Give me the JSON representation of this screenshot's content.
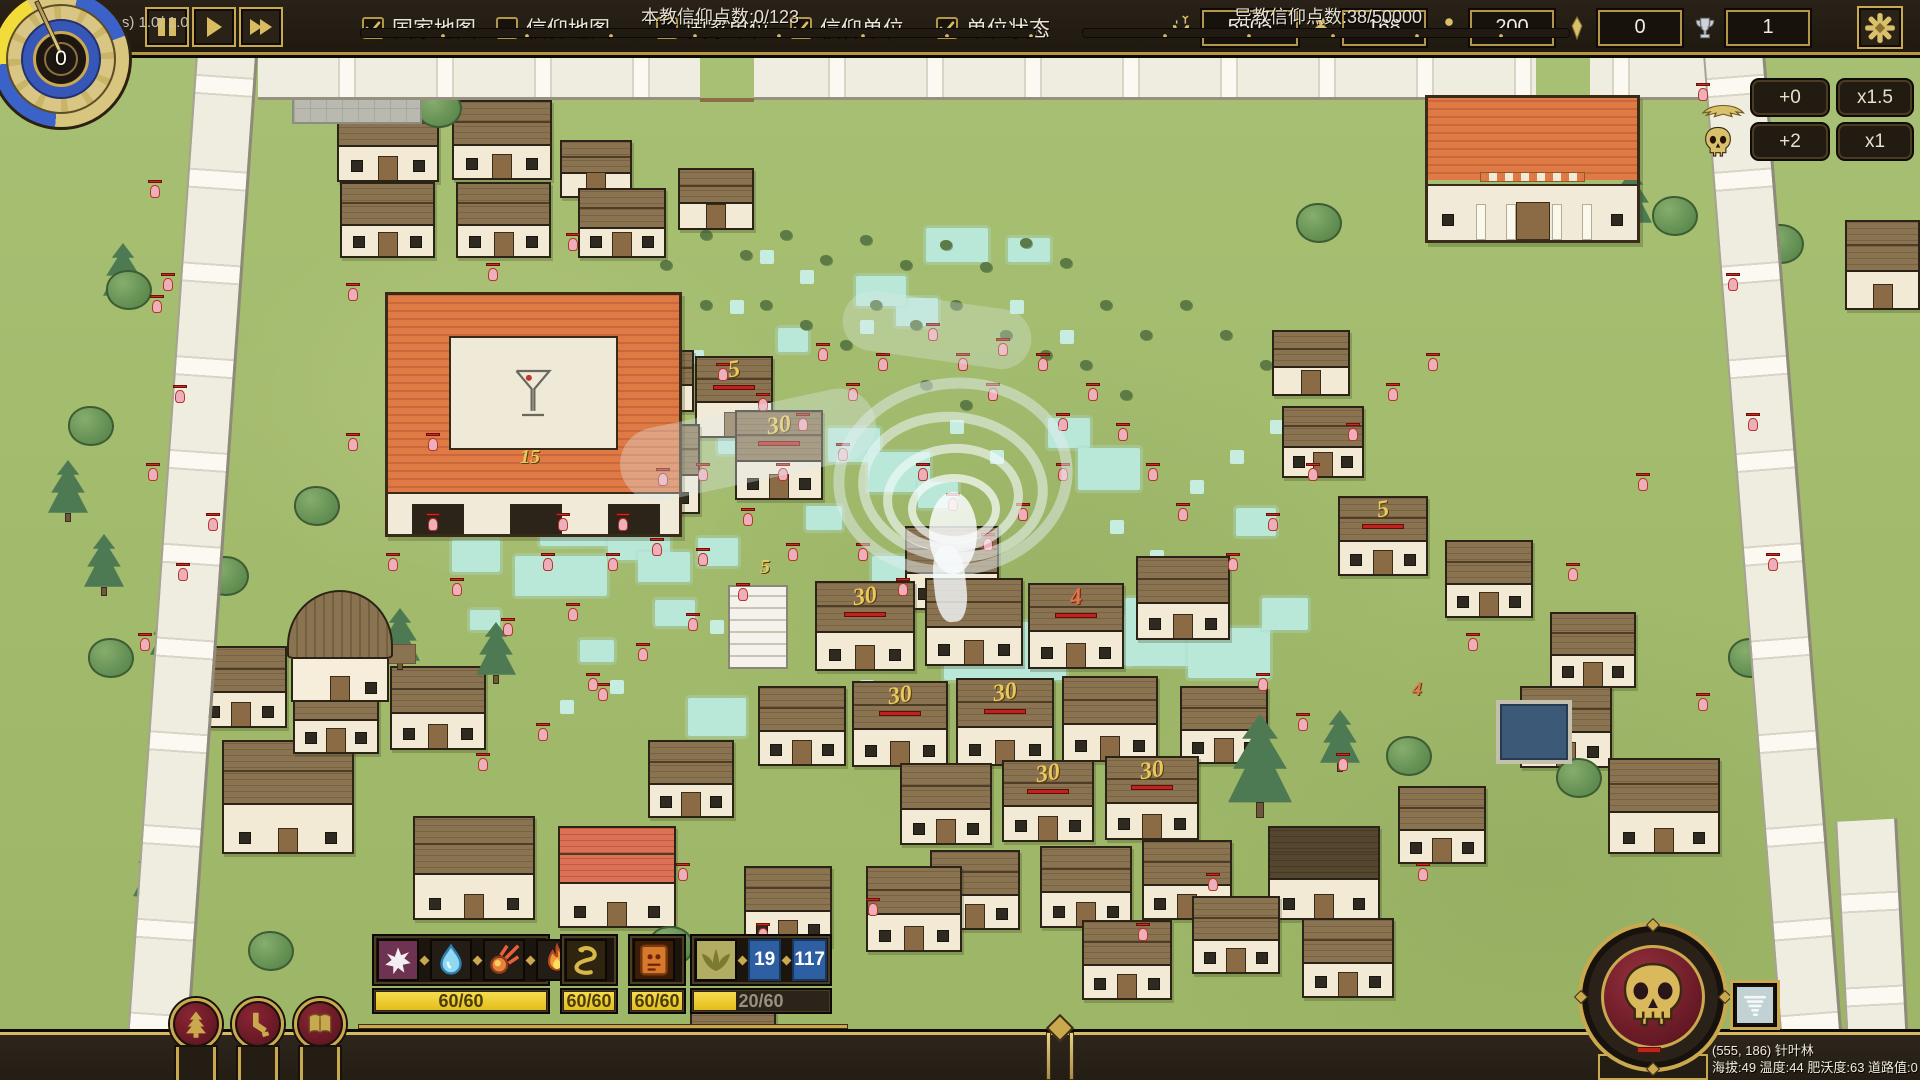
{
  "top_bar": {
    "playback": [
      {
        "name": "pause-button",
        "icon": "pause"
      },
      {
        "name": "play-button",
        "icon": "play"
      },
      {
        "name": "fast-forward-button",
        "icon": "ff"
      }
    ],
    "toggles": [
      {
        "name": "country-map",
        "label": "国家地图",
        "checked": true,
        "gap": 20
      },
      {
        "name": "faith-map",
        "label": "信仰地图",
        "checked": false,
        "gap": 46
      },
      {
        "name": "country-units",
        "label": "国家单位",
        "checked": false,
        "gap": 20
      },
      {
        "name": "faith-units",
        "label": "信仰单位",
        "checked": true,
        "gap": 32
      },
      {
        "name": "unit-status",
        "label": "单位状态",
        "checked": true,
        "gap": 0
      }
    ],
    "resources": [
      {
        "icon": "deer-icon",
        "value": "5505",
        "wide": true
      },
      {
        "icon": "rabbit-icon",
        "value": "168",
        "wide": false
      },
      {
        "icon": "person-icon",
        "value": "200",
        "wide": false
      },
      {
        "icon": "gem-icon",
        "value": "0",
        "wide": false
      },
      {
        "icon": "trophy-icon",
        "value": "1",
        "wide": false
      }
    ]
  },
  "clock": {
    "value": "0"
  },
  "modifier_panel": {
    "rows": [
      {
        "icon": "winged-idol-icon",
        "add": "+0",
        "mult": "x1.5"
      },
      {
        "icon": "skull-small-icon",
        "add": "+2",
        "mult": "x1"
      }
    ]
  },
  "abilities": {
    "groups": [
      {
        "x": 372,
        "w": 178,
        "icons": [
          "splat-icon",
          "waterdrop-icon",
          "meteor-icon",
          "flame-icon"
        ],
        "cooldown": "60/60",
        "fill": 100
      },
      {
        "x": 560,
        "w": 58,
        "icons": [
          "snake-icon"
        ],
        "cooldown": "60/60",
        "fill": 100
      },
      {
        "x": 628,
        "w": 58,
        "icons": [
          "tablet-icon"
        ],
        "cooldown": "60/60",
        "fill": 100
      },
      {
        "x": 690,
        "w": 142,
        "icons": [
          "wings-icon"
        ],
        "counters": [
          "19",
          "117"
        ],
        "cooldown": "20/60",
        "fill": 33
      }
    ]
  },
  "medallions": [
    {
      "name": "nature-medallion",
      "icon": "tree-icon"
    },
    {
      "name": "beast-medallion",
      "icon": "paw-icon"
    },
    {
      "name": "lore-medallion",
      "icon": "book-icon"
    }
  ],
  "faith": {
    "own": "本教信仰点数:0/123",
    "enemy": "异教信仰点数:38/50000"
  },
  "perf": "16.7 ms (60 fps) 1.0/ 1.0",
  "tile_info": {
    "line1": "(555, 186) 针叶林",
    "line2": "海拔:49 温度:44 肥沃度:63 道路值:0"
  },
  "map": {
    "houses": [
      [
        337,
        100,
        102,
        82,
        "b"
      ],
      [
        452,
        100,
        100,
        80,
        "b"
      ],
      [
        340,
        182,
        95,
        76,
        "b"
      ],
      [
        456,
        182,
        95,
        76,
        "b"
      ],
      [
        560,
        140,
        72,
        58,
        "b"
      ],
      [
        578,
        188,
        88,
        70,
        "b"
      ],
      [
        678,
        168,
        76,
        62,
        "b"
      ],
      [
        622,
        350,
        72,
        62,
        "b"
      ],
      [
        695,
        356,
        78,
        82,
        "b",
        "5",
        "g"
      ],
      [
        618,
        424,
        82,
        90,
        "b"
      ],
      [
        735,
        410,
        88,
        90,
        "b",
        "30",
        "g"
      ],
      [
        905,
        526,
        94,
        84,
        "b"
      ],
      [
        1136,
        556,
        94,
        84,
        "b"
      ],
      [
        815,
        581,
        100,
        90,
        "b",
        "30",
        "g"
      ],
      [
        925,
        578,
        98,
        88,
        "b"
      ],
      [
        1028,
        583,
        96,
        86,
        "b",
        "4",
        "o"
      ],
      [
        758,
        686,
        88,
        80,
        "b"
      ],
      [
        852,
        681,
        96,
        86,
        "b",
        "30",
        "g"
      ],
      [
        956,
        678,
        98,
        88,
        "b",
        "30",
        "g"
      ],
      [
        1062,
        676,
        96,
        86,
        "b"
      ],
      [
        1180,
        686,
        88,
        78,
        "b"
      ],
      [
        900,
        763,
        92,
        82,
        "b"
      ],
      [
        1002,
        760,
        92,
        82,
        "b",
        "30",
        "g"
      ],
      [
        1105,
        756,
        94,
        84,
        "b",
        "30",
        "g"
      ],
      [
        930,
        850,
        90,
        80,
        "b"
      ],
      [
        1040,
        846,
        92,
        82,
        "b"
      ],
      [
        1142,
        840,
        90,
        80,
        "b"
      ],
      [
        1282,
        406,
        82,
        72,
        "b"
      ],
      [
        1272,
        330,
        78,
        66,
        "b"
      ],
      [
        1338,
        496,
        90,
        80,
        "b",
        "5",
        "g"
      ],
      [
        1445,
        540,
        88,
        78,
        "b"
      ],
      [
        1550,
        612,
        86,
        76,
        "b"
      ],
      [
        1520,
        686,
        92,
        82,
        "b"
      ],
      [
        1608,
        758,
        112,
        96,
        "b"
      ],
      [
        195,
        646,
        92,
        82,
        "b"
      ],
      [
        222,
        740,
        132,
        114,
        "b"
      ],
      [
        390,
        666,
        96,
        84,
        "b"
      ],
      [
        293,
        676,
        86,
        78,
        "b"
      ],
      [
        413,
        816,
        122,
        104,
        "b"
      ],
      [
        558,
        826,
        118,
        102,
        "r"
      ],
      [
        648,
        740,
        86,
        78,
        "b"
      ],
      [
        866,
        866,
        96,
        86,
        "b"
      ],
      [
        744,
        866,
        88,
        80,
        "b"
      ],
      [
        1268,
        826,
        112,
        94,
        "d"
      ],
      [
        1398,
        786,
        88,
        78,
        "b"
      ],
      [
        1845,
        220,
        75,
        90,
        "b"
      ],
      [
        1082,
        920,
        90,
        80,
        "b"
      ],
      [
        1192,
        896,
        88,
        78,
        "b"
      ],
      [
        1302,
        918,
        92,
        80,
        "b"
      ],
      [
        690,
        993,
        86,
        72,
        "b"
      ]
    ],
    "trees": [
      [
        48,
        460,
        "p"
      ],
      [
        84,
        534,
        "p"
      ],
      [
        150,
        602,
        "p"
      ],
      [
        380,
        608,
        "p"
      ],
      [
        476,
        622,
        "p"
      ],
      [
        598,
        442,
        "p"
      ],
      [
        103,
        243,
        "p"
      ],
      [
        1320,
        710,
        "p"
      ],
      [
        1612,
        170,
        "p"
      ],
      [
        1742,
        194,
        "p"
      ],
      [
        133,
        808,
        "P"
      ],
      [
        1228,
        714,
        "P"
      ],
      [
        106,
        270,
        "r"
      ],
      [
        68,
        406,
        "r"
      ],
      [
        1296,
        203,
        "r"
      ],
      [
        1652,
        196,
        "r"
      ],
      [
        1758,
        224,
        "r"
      ],
      [
        1386,
        736,
        "r"
      ],
      [
        294,
        486,
        "r"
      ],
      [
        416,
        88,
        "r"
      ],
      [
        203,
        556,
        "r"
      ],
      [
        88,
        638,
        "r"
      ],
      [
        1728,
        638,
        "r"
      ],
      [
        1556,
        758,
        "r"
      ],
      [
        648,
        926,
        "r"
      ],
      [
        248,
        931,
        "r"
      ]
    ],
    "bushes": [
      [
        620,
        240
      ],
      [
        660,
        260
      ],
      [
        700,
        230
      ],
      [
        740,
        250
      ],
      [
        780,
        230
      ],
      [
        820,
        255
      ],
      [
        860,
        235
      ],
      [
        900,
        260
      ],
      [
        940,
        240
      ],
      [
        980,
        262
      ],
      [
        1020,
        238
      ],
      [
        1060,
        258
      ],
      [
        870,
        300
      ],
      [
        910,
        320
      ],
      [
        950,
        300
      ],
      [
        760,
        300
      ],
      [
        800,
        320
      ],
      [
        840,
        340
      ],
      [
        700,
        300
      ],
      [
        650,
        330
      ],
      [
        610,
        360
      ],
      [
        1100,
        300
      ],
      [
        1140,
        330
      ],
      [
        1180,
        300
      ],
      [
        1220,
        330
      ],
      [
        1260,
        360
      ],
      [
        1000,
        330
      ],
      [
        1040,
        350
      ],
      [
        920,
        380
      ],
      [
        960,
        400
      ],
      [
        1080,
        360
      ],
      [
        1120,
        390
      ]
    ],
    "water": [
      [
        497,
        468,
        58,
        38
      ],
      [
        540,
        498,
        85,
        48
      ],
      [
        608,
        518,
        62,
        42
      ],
      [
        452,
        540,
        48,
        32
      ],
      [
        515,
        556,
        92,
        40
      ],
      [
        638,
        552,
        52,
        30
      ],
      [
        698,
        538,
        40,
        28
      ],
      [
        566,
        470,
        36,
        26
      ],
      [
        488,
        430,
        40,
        28
      ],
      [
        828,
        428,
        52,
        34
      ],
      [
        868,
        452,
        62,
        40
      ],
      [
        896,
        298,
        42,
        28
      ],
      [
        856,
        276,
        50,
        30
      ],
      [
        926,
        228,
        62,
        34
      ],
      [
        1008,
        238,
        42,
        24
      ],
      [
        778,
        328,
        30,
        24
      ],
      [
        1048,
        418,
        42,
        30
      ],
      [
        1078,
        448,
        62,
        42
      ],
      [
        944,
        622,
        122,
        58
      ],
      [
        1038,
        615,
        92,
        50
      ],
      [
        1125,
        598,
        102,
        68
      ],
      [
        1188,
        628,
        82,
        50
      ],
      [
        1262,
        598,
        46,
        32
      ],
      [
        688,
        698,
        58,
        38
      ],
      [
        902,
        902,
        58,
        32
      ],
      [
        756,
        926,
        48,
        28
      ],
      [
        1236,
        508,
        40,
        28
      ],
      [
        872,
        556,
        46,
        30
      ],
      [
        806,
        506,
        36,
        24
      ],
      [
        918,
        482,
        40,
        26
      ],
      [
        718,
        432,
        34,
        22
      ],
      [
        655,
        600,
        40,
        26
      ],
      [
        580,
        640,
        34,
        22
      ],
      [
        470,
        610,
        30,
        20
      ],
      [
        760,
        250,
        14,
        14
      ],
      [
        800,
        270,
        14,
        14
      ],
      [
        860,
        320,
        14,
        14
      ],
      [
        1010,
        300,
        14,
        14
      ],
      [
        1060,
        330,
        14,
        14
      ],
      [
        640,
        380,
        14,
        14
      ],
      [
        690,
        350,
        14,
        14
      ],
      [
        730,
        300,
        14,
        14
      ],
      [
        950,
        420,
        14,
        14
      ],
      [
        990,
        450,
        14,
        14
      ],
      [
        1110,
        520,
        14,
        14
      ],
      [
        1150,
        550,
        14,
        14
      ],
      [
        830,
        620,
        14,
        14
      ],
      [
        770,
        650,
        14,
        14
      ],
      [
        710,
        620,
        14,
        14
      ],
      [
        610,
        680,
        14,
        14
      ],
      [
        560,
        700,
        14,
        14
      ],
      [
        1190,
        480,
        14,
        14
      ],
      [
        1230,
        450,
        14,
        14
      ],
      [
        1270,
        420,
        14,
        14
      ],
      [
        860,
        680,
        14,
        14
      ],
      [
        920,
        700,
        14,
        14
      ],
      [
        980,
        720,
        14,
        14
      ],
      [
        1040,
        740,
        14,
        14
      ]
    ],
    "units": [
      [
        150,
        185
      ],
      [
        163,
        278
      ],
      [
        152,
        300
      ],
      [
        175,
        390
      ],
      [
        148,
        468
      ],
      [
        208,
        518
      ],
      [
        178,
        568
      ],
      [
        140,
        638
      ],
      [
        388,
        558
      ],
      [
        428,
        518
      ],
      [
        452,
        583
      ],
      [
        503,
        623
      ],
      [
        543,
        558
      ],
      [
        568,
        608
      ],
      [
        608,
        558
      ],
      [
        652,
        543
      ],
      [
        698,
        553
      ],
      [
        743,
        513
      ],
      [
        778,
        468
      ],
      [
        698,
        468
      ],
      [
        658,
        473
      ],
      [
        618,
        518
      ],
      [
        558,
        518
      ],
      [
        818,
        348
      ],
      [
        848,
        388
      ],
      [
        878,
        358
      ],
      [
        928,
        328
      ],
      [
        958,
        358
      ],
      [
        998,
        343
      ],
      [
        1038,
        358
      ],
      [
        988,
        388
      ],
      [
        1058,
        418
      ],
      [
        1088,
        388
      ],
      [
        1118,
        428
      ],
      [
        1148,
        468
      ],
      [
        1178,
        508
      ],
      [
        1058,
        468
      ],
      [
        1018,
        508
      ],
      [
        983,
        538
      ],
      [
        858,
        548
      ],
      [
        898,
        583
      ],
      [
        1228,
        558
      ],
      [
        1268,
        518
      ],
      [
        1308,
        468
      ],
      [
        1348,
        428
      ],
      [
        1388,
        388
      ],
      [
        1428,
        358
      ],
      [
        1698,
        88
      ],
      [
        1728,
        278
      ],
      [
        1748,
        418
      ],
      [
        1768,
        558
      ],
      [
        1698,
        698
      ],
      [
        868,
        903
      ],
      [
        758,
        928
      ],
      [
        678,
        868
      ],
      [
        1138,
        928
      ],
      [
        1208,
        878
      ],
      [
        1418,
        868
      ],
      [
        348,
        288
      ],
      [
        568,
        238
      ],
      [
        488,
        268
      ],
      [
        428,
        438
      ],
      [
        348,
        438
      ],
      [
        1468,
        638
      ],
      [
        1568,
        568
      ],
      [
        1638,
        478
      ],
      [
        598,
        688
      ],
      [
        538,
        728
      ],
      [
        478,
        758
      ],
      [
        918,
        468
      ],
      [
        948,
        498
      ],
      [
        838,
        448
      ],
      [
        788,
        548
      ],
      [
        738,
        588
      ],
      [
        688,
        618
      ],
      [
        638,
        648
      ],
      [
        588,
        678
      ],
      [
        1258,
        678
      ],
      [
        1298,
        718
      ],
      [
        1338,
        758
      ],
      [
        758,
        398
      ],
      [
        718,
        368
      ],
      [
        798,
        418
      ]
    ],
    "floating_labels": [
      [
        520,
        446,
        "15",
        "g"
      ],
      [
        760,
        556,
        "5",
        "g"
      ],
      [
        1412,
        678,
        "4",
        "o"
      ]
    ]
  }
}
